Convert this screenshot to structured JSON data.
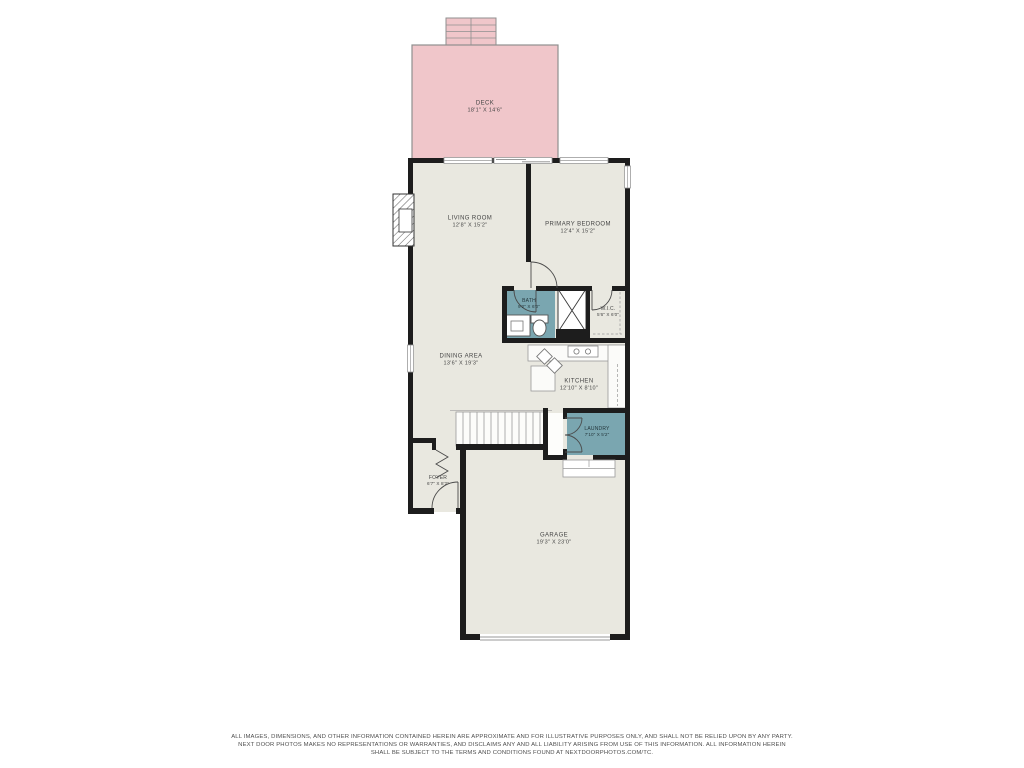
{
  "floorplan": {
    "title": "First floor plan",
    "rooms": [
      {
        "id": "deck",
        "name": "DECK",
        "dims": "18'1\" X 14'6\""
      },
      {
        "id": "living-room",
        "name": "LIVING ROOM",
        "dims": "12'8\" X 15'2\""
      },
      {
        "id": "primary-bedroom",
        "name": "PRIMARY BEDROOM",
        "dims": "12'4\" X 15'2\""
      },
      {
        "id": "bath",
        "name": "BATH",
        "dims": "9'2\" X 6'0\""
      },
      {
        "id": "wic",
        "name": "W.I.C.",
        "dims": "5'6\" X 6'0\""
      },
      {
        "id": "dining-area",
        "name": "DINING AREA",
        "dims": "13'6\" X 19'3\""
      },
      {
        "id": "kitchen",
        "name": "KITCHEN",
        "dims": "12'10\" X 8'10\""
      },
      {
        "id": "laundry",
        "name": "LAUNDRY",
        "dims": "7'10\" X 5'2\""
      },
      {
        "id": "foyer",
        "name": "FOYER",
        "dims": "6'7\" X 8'2\""
      },
      {
        "id": "garage",
        "name": "GARAGE",
        "dims": "19'3\" X 23'0\""
      }
    ],
    "colors": {
      "deck_fill": "#f0c6ca",
      "floor_fill": "#e9e8e0",
      "wet_room_fill": "#7aa6b0",
      "wall": "#1d1d1d"
    },
    "disclaimer": {
      "line1": "ALL IMAGES, DIMENSIONS, AND OTHER INFORMATION CONTAINED HEREIN ARE APPROXIMATE AND FOR ILLUSTRATIVE PURPOSES ONLY, AND SHALL NOT BE RELIED UPON BY ANY PARTY.",
      "line2": "NEXT DOOR PHOTOS MAKES NO REPRESENTATIONS OR WARRANTIES, AND DISCLAIMS ANY AND ALL LIABILITY ARISING FROM USE OF THIS INFORMATION. ALL INFORMATION HEREIN",
      "line3": "SHALL BE SUBJECT TO THE TERMS AND CONDITIONS FOUND AT NEXTDOORPHOTOS.COM/TC."
    }
  }
}
